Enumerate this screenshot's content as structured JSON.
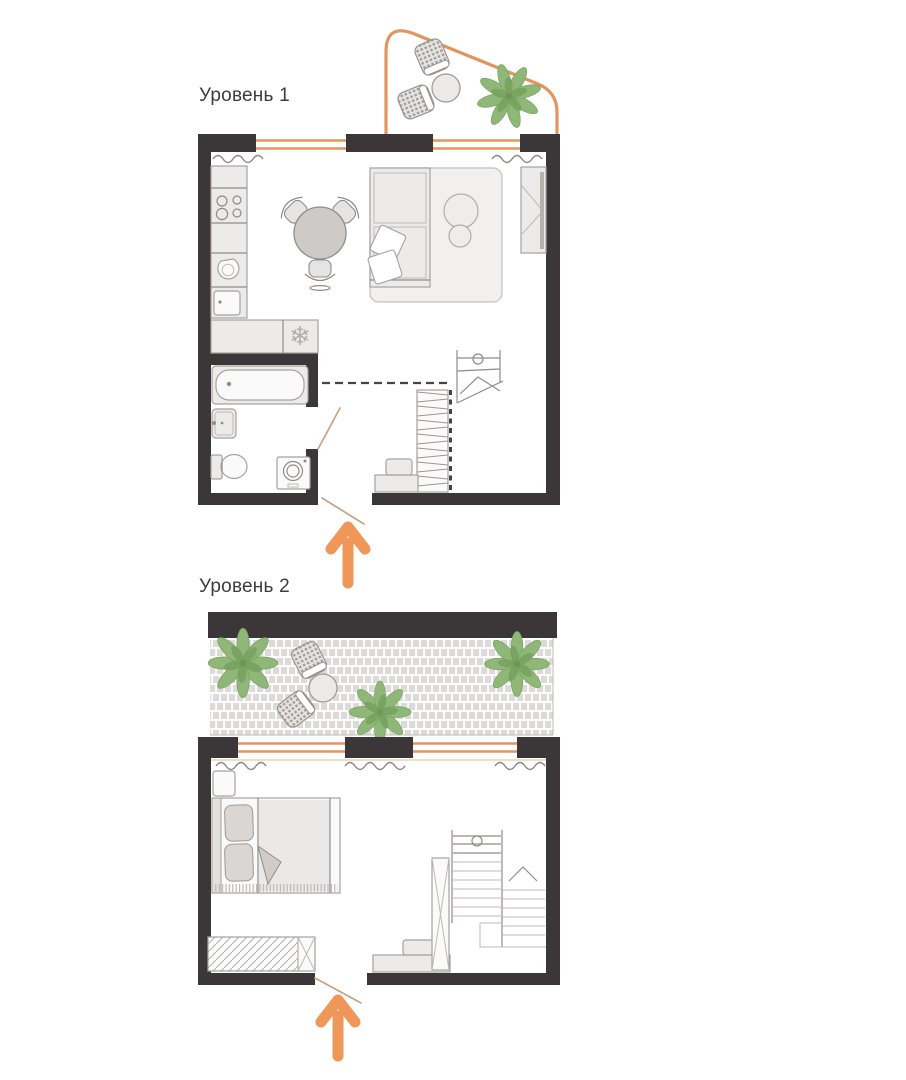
{
  "page": {
    "width": 906,
    "height": 1080,
    "background": "#ffffff"
  },
  "colors": {
    "page_bg": "#ffffff",
    "wall": "#3b3738",
    "accent_orange": "#ef9659",
    "window_orange": "#e2955e",
    "door_swing": "#c9a183",
    "plant_green": "#8fb878",
    "plant_dark": "#76a05e",
    "furniture_fill": "#edebe9",
    "furniture_stroke": "#a5a2a0",
    "detail_stroke": "#8f8c8a",
    "table_fill": "#cdcac8",
    "paver_fill": "#dddbda",
    "label_text": "#3d3c3c"
  },
  "levels": [
    {
      "label": "Уровень 1",
      "areas": [
        "balcony",
        "kitchen-living-room",
        "bathroom",
        "hall"
      ],
      "icons": [
        "balcony-outline",
        "wicker-chair-icon",
        "wicker-chair-icon",
        "round-table-icon",
        "plant-icon",
        "window-icon",
        "radiator-icon",
        "kitchen-counter-icon",
        "hob-icon",
        "sink-icon",
        "kitchen-sink-icon",
        "snowflake-fridge-icon",
        "dining-table-icon",
        "dining-chair-icon",
        "sofa-icon",
        "rug-icon",
        "pouf-icon",
        "wardrobe-icon",
        "bathtub-icon",
        "washbasin-icon",
        "toilet-icon",
        "washing-machine-icon",
        "mezzanine-dashed-edge",
        "staircase-icon",
        "stair-railing-icon",
        "bench-icon",
        "door-swing-icon",
        "entrance-arrow-icon"
      ]
    },
    {
      "label": "Уровень 2",
      "areas": [
        "terrace",
        "bedroom",
        "hall"
      ],
      "icons": [
        "terrace-paving",
        "plant-icon",
        "plant-icon",
        "plant-icon",
        "wicker-chair-icon",
        "wicker-chair-icon",
        "round-table-icon",
        "window-icon",
        "radiator-icon",
        "nightstand-icon",
        "double-bed-icon",
        "pillow-icon",
        "blanket-icon",
        "wardrobe-icon",
        "tall-cabinet-icon",
        "staircase-icon",
        "stair-railing-icon",
        "stair-up-arrow-icon",
        "bench-icon",
        "door-swing-icon",
        "entrance-arrow-icon"
      ]
    }
  ]
}
